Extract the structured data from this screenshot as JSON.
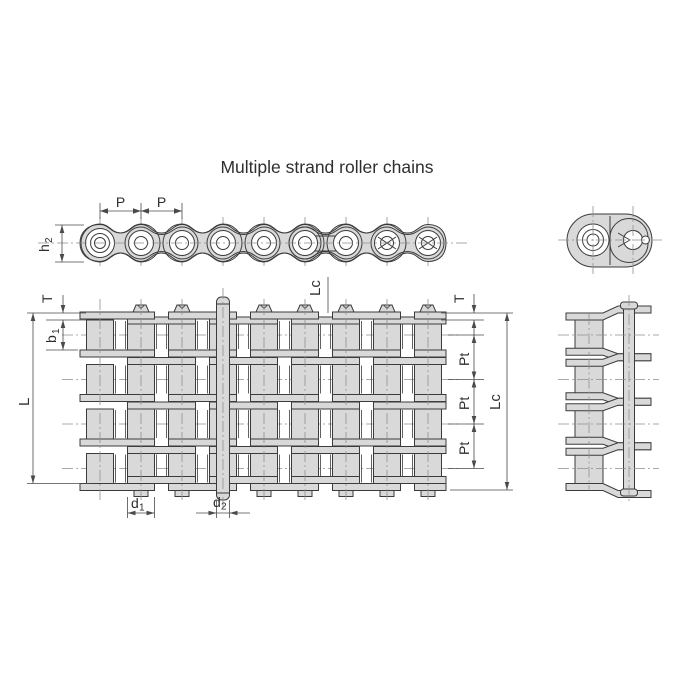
{
  "title": "Multiple strand roller chains",
  "colors": {
    "body_fill": "#d9d9d9",
    "line": "#3b3b3b",
    "centerline": "#8f8f8f",
    "text": "#2e2e2e",
    "background": "#ffffff"
  },
  "labels": {
    "pitch_1": "P",
    "pitch_2": "P",
    "h2": {
      "base": "h",
      "sub": "2"
    },
    "lc_top": "Lc",
    "t_left": "T",
    "b1": {
      "base": "b",
      "sub": "1"
    },
    "length_l": "L",
    "t_right": "T",
    "pt_1": "Pt",
    "pt_2": "Pt",
    "pt_3": "Pt",
    "lc_right": "Lc",
    "d1": {
      "base": "d",
      "sub": "1"
    },
    "d2": {
      "base": "d",
      "sub": "2"
    }
  }
}
